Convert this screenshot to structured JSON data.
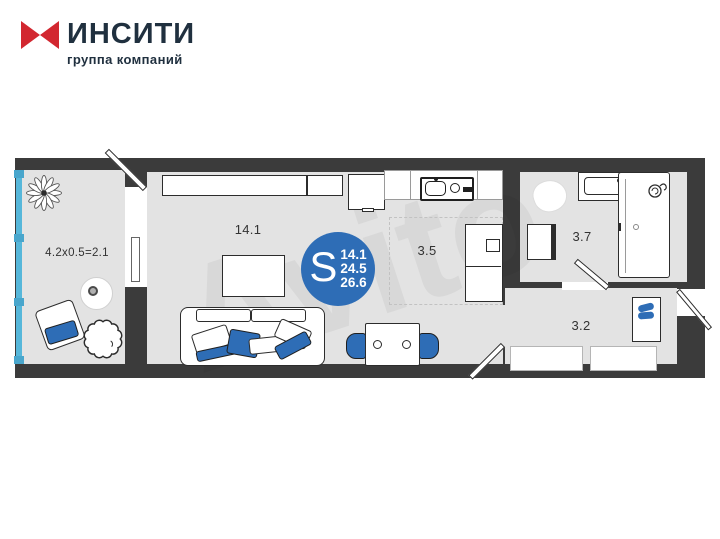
{
  "header": {
    "brand": "ИНСИТИ",
    "brand_sub": "группа компаний"
  },
  "plan": {
    "watermark": "Avito",
    "labels": {
      "living": "14.1",
      "kitchen": "3.5",
      "bathroom": "3.7",
      "hallway": "3.2",
      "balcony": "4.2x0.5=2.1"
    },
    "area": {
      "letter": "S",
      "values": [
        "14.1",
        "24.5",
        "26.6"
      ]
    },
    "colors": {
      "accent_blue": "#2e6db6",
      "glazing_cyan": "#56b7da",
      "wall_dark": "#3b3b3b",
      "floor_gray": "#e3e3e3",
      "brand_red": "#d22730",
      "brand_navy": "#20303f"
    }
  }
}
